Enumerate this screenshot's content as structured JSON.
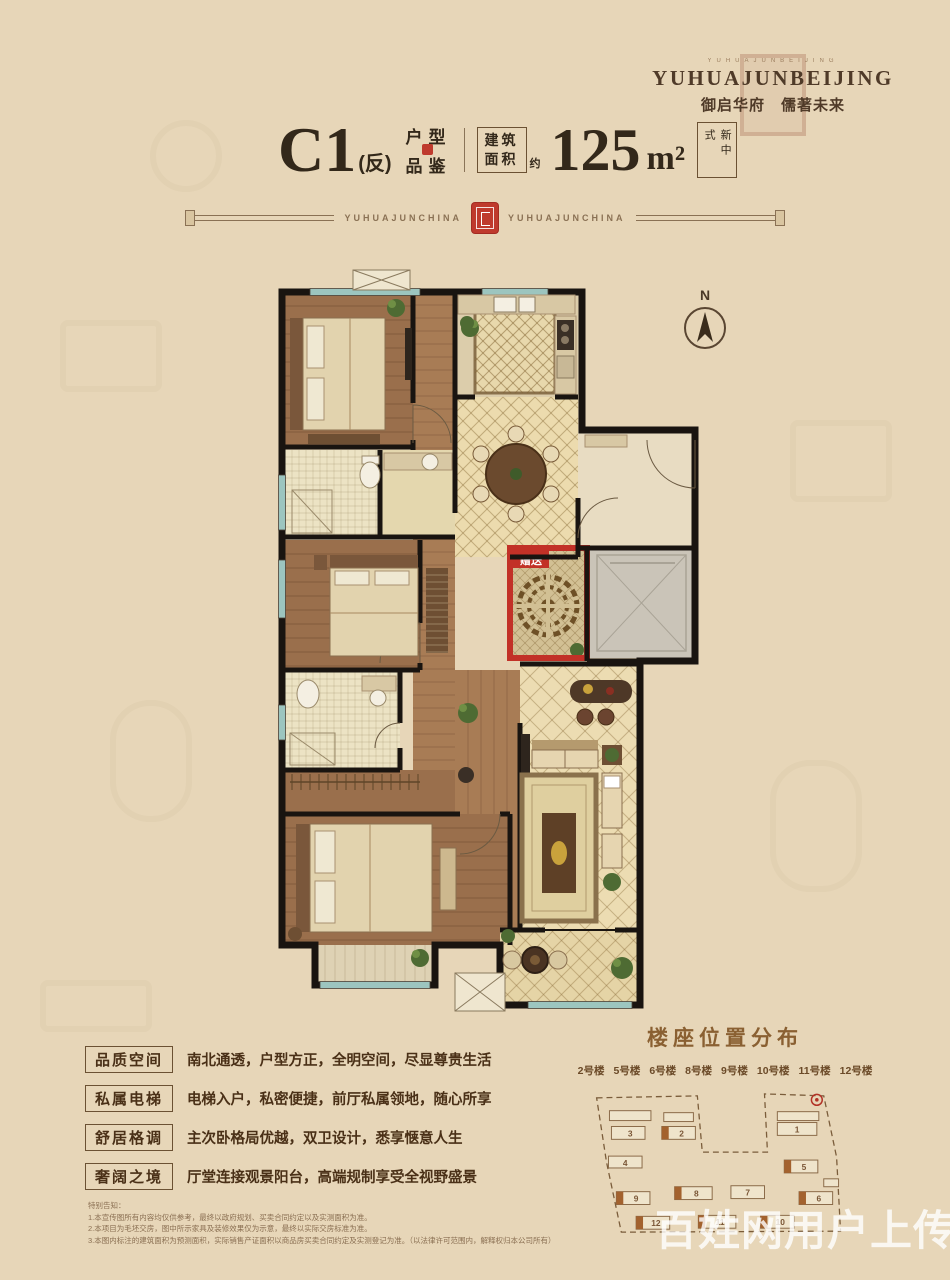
{
  "colors": {
    "background": "#e7d6b8",
    "accent_red": "#bf3a2d",
    "text_brown": "#44331f",
    "band": "#8a7154",
    "window_teal": "#9cc5bf",
    "wall": "#191410"
  },
  "logo": {
    "tiny_line": "YUHUAJUNBEIJING",
    "name_en": "YUHUAJUNBEIJING",
    "name_cn": "御启华府　儒著未来"
  },
  "title": {
    "model": "C1",
    "model_suffix": "(反)",
    "label_top": "户型",
    "label_bottom": "品鉴",
    "area_box_line1": "建筑",
    "area_box_line2": "面积",
    "area_approx": "约",
    "area_value": "125",
    "area_unit": "m²",
    "style_tag": "新中式"
  },
  "band": {
    "left_text": "YUHUAJUNCHINA",
    "right_text": "YUHUAJUNCHINA"
  },
  "plan": {
    "north_label": "N",
    "bonus_label": "赠送"
  },
  "features": [
    {
      "label": "品质空间",
      "desc": "南北通透，户型方正，全明空间，尽显尊贵生活"
    },
    {
      "label": "私属电梯",
      "desc": "电梯入户，私密便捷，前厅私属领地，随心所享"
    },
    {
      "label": "舒居格调",
      "desc": "主次卧格局优越，双卫设计，悉享惬意人生"
    },
    {
      "label": "奢阔之境",
      "desc": "厅堂连接观景阳台，高端规制享受全视野盛景"
    }
  ],
  "siteplan": {
    "title": "楼座位置分布",
    "buildings": [
      "2号楼",
      "5号楼",
      "6号楼",
      "8号楼",
      "9号楼",
      "10号楼",
      "11号楼",
      "12号楼"
    ],
    "blocks": [
      {
        "n": "3"
      },
      {
        "n": "2"
      },
      {
        "n": "1"
      },
      {
        "n": "4"
      },
      {
        "n": "5"
      },
      {
        "n": "9"
      },
      {
        "n": "8"
      },
      {
        "n": "7"
      },
      {
        "n": "6"
      },
      {
        "n": "12"
      },
      {
        "n": "11"
      },
      {
        "n": "10"
      }
    ]
  },
  "disclaimer": {
    "heading": "特别告知：",
    "lines": [
      "1.本宣传图所有内容均仅供参考，最终以政府规划、买卖合同约定以及实测面积为准。",
      "2.本项目为毛坯交房，图中所示家具及装修效果仅为示意，最终以实际交房标准为准。",
      "3.本图内标注的建筑面积为预测面积，实际销售产证面积以商品房买卖合同约定及实测登记为准。（以法律许可范围内，解释权归本公司所有）"
    ]
  },
  "watermark": "百姓网用户上传"
}
